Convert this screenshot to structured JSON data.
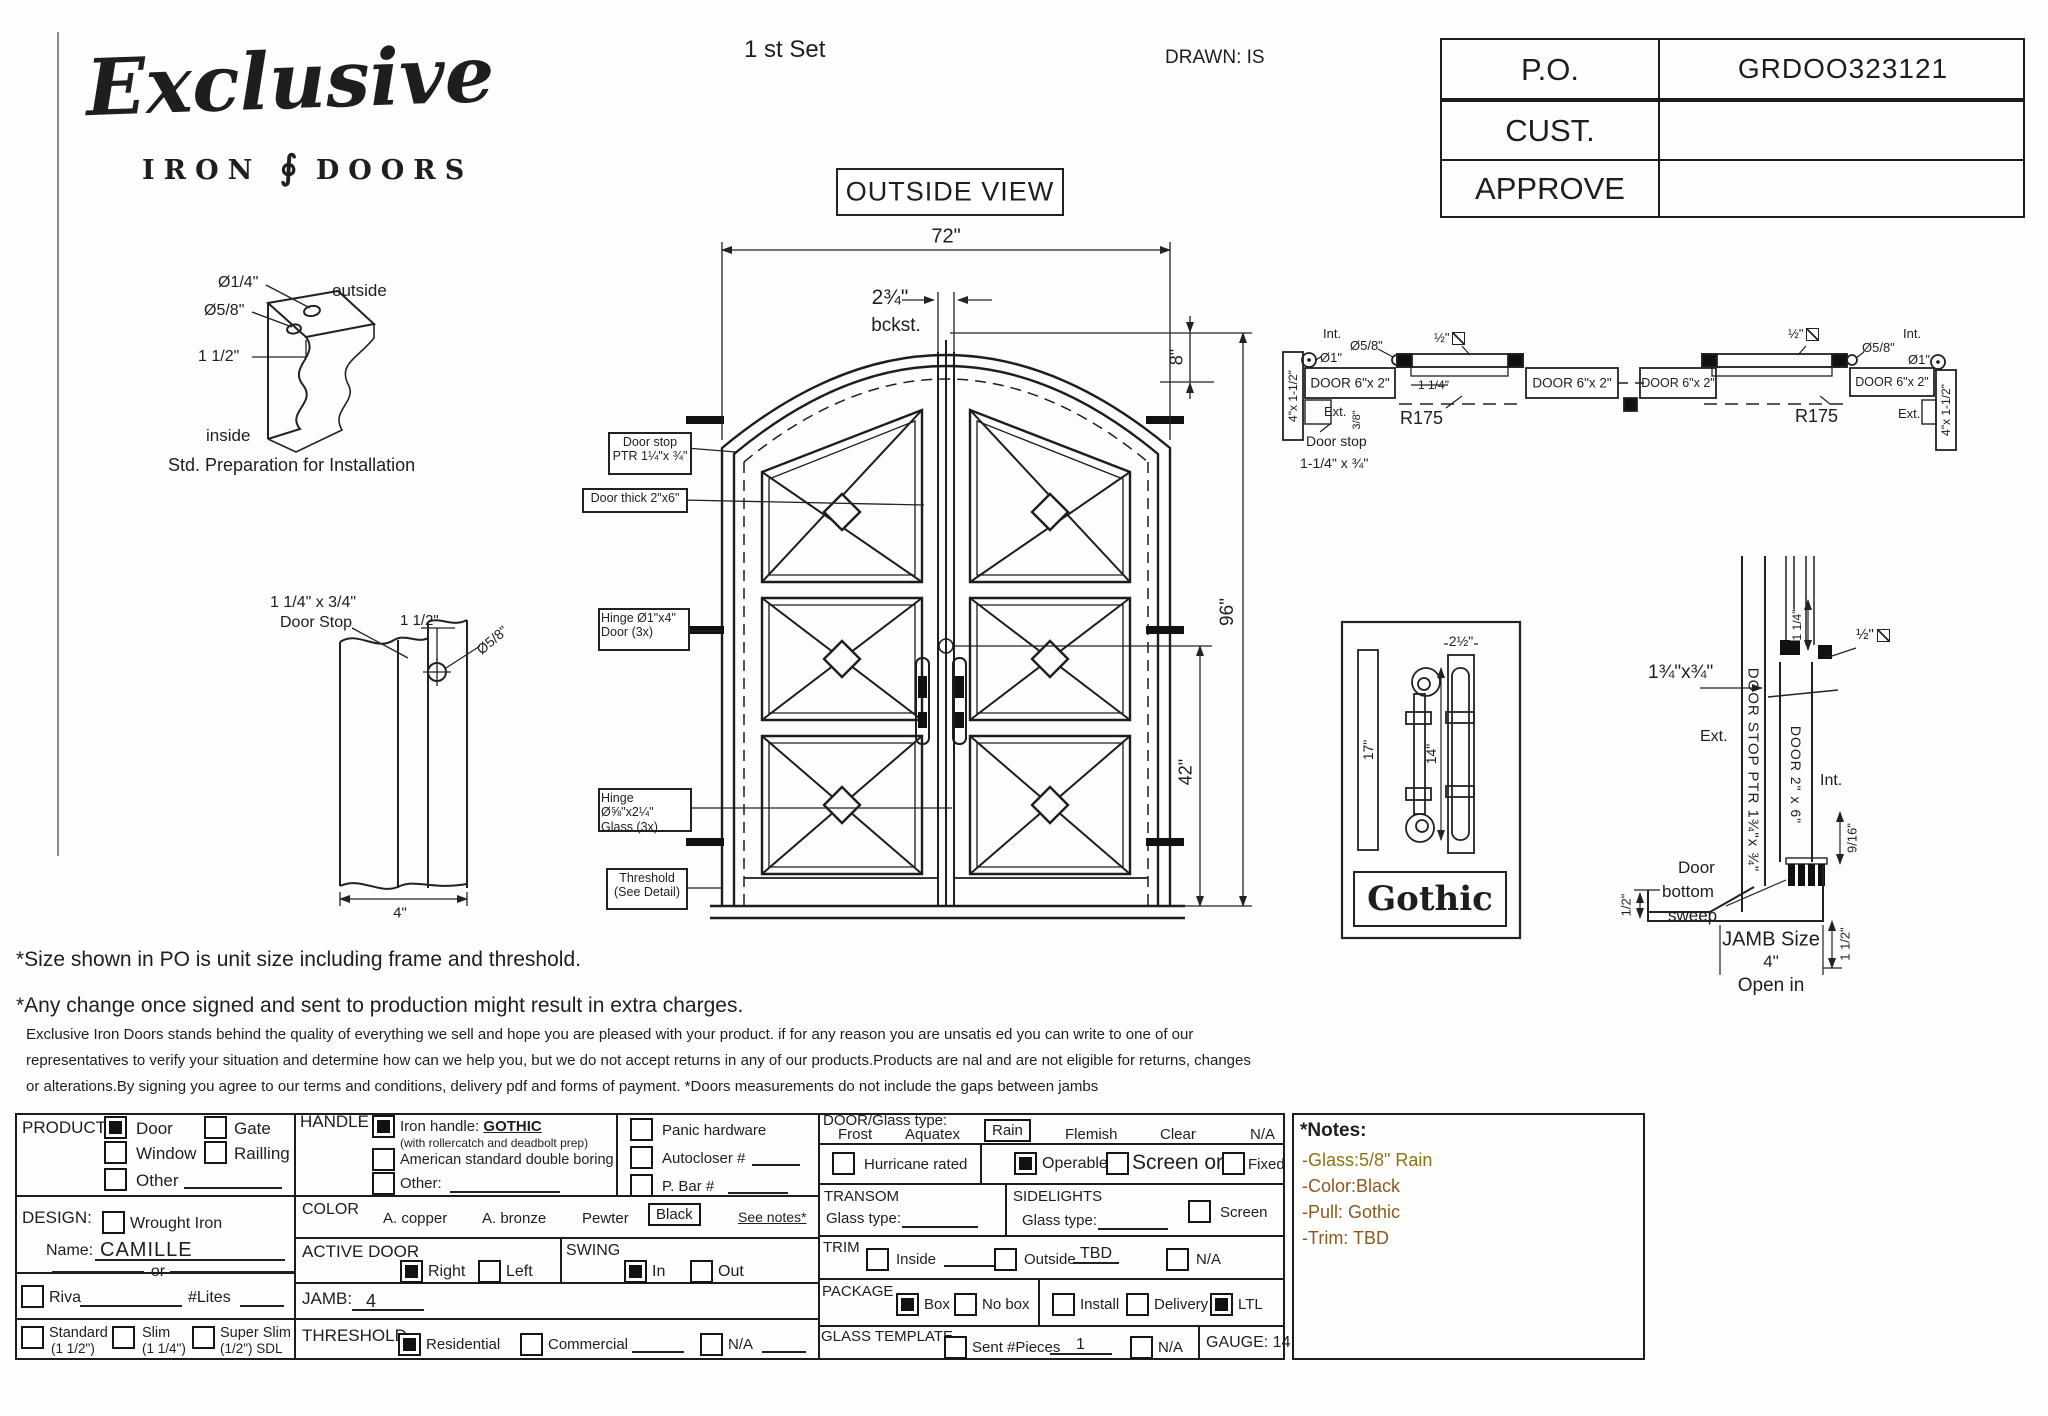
{
  "header": {
    "logo_main": "Exclusive",
    "logo_iron": "IRON",
    "logo_doors": "DOORS",
    "logo_ornament": "∮",
    "set_label": "1 st Set",
    "drawn": "DRAWN: IS",
    "po": {
      "label": "P.O.",
      "value": "GRDOO323121"
    },
    "cust": {
      "label": "CUST.",
      "value": ""
    },
    "approve": {
      "label": "APPROVE",
      "value": ""
    }
  },
  "drawing": {
    "outside_view": "OUTSIDE VIEW",
    "corner": {
      "d1": "Ø1/4\"",
      "d2": "Ø5/8\"",
      "d3": "1 1/2\"",
      "outside": "outside",
      "inside": "inside",
      "caption": "Std. Preparation for Installation"
    },
    "stop": {
      "l1": "1 1/4\" x 3/4\"",
      "l2": "Door Stop",
      "d1": "1 1/2\"",
      "d2": "Ø5/8\"",
      "d3": "4\""
    },
    "door": {
      "w": "72\"",
      "backset": "2¾\"",
      "bckst": "bckst.",
      "arch": "8\"",
      "h": "96\"",
      "handle": "42\"",
      "c1a": "Door stop",
      "c1b": "PTR 1¼\"x ¾\"",
      "c2": "Door thick 2\"x6\"",
      "c3a": "Hinge Ø1\"x4\"",
      "c3b": "Door (3x)",
      "c4a": "Hinge Ø⅝\"x2¼\"",
      "c4b": "Glass (3x)",
      "c5a": "Threshold",
      "c5b": "(See Detail)"
    },
    "hsec": {
      "int": "Int.",
      "int2": "Int.",
      "ext": "Ext.",
      "ext2": "Ext.",
      "d1": "Ø1\"",
      "d1b": "Ø1\"",
      "d58": "Ø5/8\"",
      "d58b": "Ø5/8\"",
      "jamb": "4\"x 1-1/2\"",
      "jamb2": "4\"x 1-1/2\"",
      "door": "DOOR 6\"x 2\"",
      "half": "½\"",
      "r175": "R175",
      "r175b": "R175",
      "q114": "1 1/4\"",
      "e38": "3/8\"",
      "ds1": "Door stop",
      "ds2": "1-1/4\" x ¾\""
    },
    "gothic": {
      "d17": "17\"",
      "d14": "14\"",
      "d25": "2½\"",
      "caption": "Gothic"
    },
    "jsec": {
      "size": "1¾\"x¾\"",
      "vstop": "DOOR STOP PTR 1¾\"x ¾\"",
      "vdoor": "DOOR 2\" x 6\"",
      "q114": "1 1/4\"",
      "half": "½\"",
      "ext": "Ext.",
      "int": "Int.",
      "n916": "9/16\"",
      "sw1": "Door",
      "sw2": "bottom",
      "sw3": "sweep",
      "h12": "1/2\"",
      "jamb1": "JAMB Size",
      "jamb2": "4\"",
      "open": "Open in",
      "oh": "1 1/2\""
    }
  },
  "disclaimer": {
    "line1": "*Size shown in PO is unit size including frame and threshold.",
    "line2": "*Any change once signed and sent to production might result in extra charges.",
    "p1": "Exclusive Iron Doors stands behind the quality of everything we sell and hope you are pleased with your product. if for any reason you are unsatis  ed you can write to one of our",
    "p2": "representatives to verify your situation and determine how can we help you, but we do not accept returns in any of our products.Products are    nal and are not eligible for returns, changes",
    "p3": "or alterations.By signing you agree to our terms and conditions, delivery pdf and forms of payment. *Doors measurements do not include the gaps between jambs"
  },
  "form": {
    "product": {
      "label": "PRODUCT:",
      "door": "Door",
      "gate": "Gate",
      "window": "Window",
      "railling": "Railling",
      "other": "Other"
    },
    "handle": {
      "label": "HANDLE",
      "iron": "Iron handle:",
      "iron_value": "GOTHIC",
      "iron_sub": "(with rollercatch and deadbolt prep)",
      "american": "American standard double boring",
      "other": "Other:"
    },
    "extras": {
      "panic": "Panic hardware",
      "autocloser": "Autocloser #",
      "pbar": "P. Bar #"
    },
    "design": {
      "label": "DESIGN:",
      "wrought": "Wrought Iron",
      "name_label": "Name:",
      "name_value": "CAMILLE",
      "or": "or",
      "riva": "Riva",
      "lites": "#Lites",
      "standard": "Standard",
      "standard_sub": "(1 1/2\")",
      "slim": "Slim",
      "slim_sub": "(1 1/4\")",
      "superslim": "Super Slim",
      "superslim_sub": "(1/2\") SDL"
    },
    "color": {
      "label": "COLOR",
      "copper": "A. copper",
      "bronze": "A. bronze",
      "pewter": "Pewter",
      "black": "Black",
      "see_notes": "See notes*"
    },
    "active": {
      "label": "ACTIVE DOOR",
      "right": "Right",
      "left": "Left",
      "swing": "SWING",
      "in": "In",
      "out": "Out"
    },
    "jamb": {
      "label": "JAMB:",
      "value": "4"
    },
    "threshold": {
      "label": "THRESHOLD",
      "residential": "Residential",
      "commercial": "Commercial",
      "na": "N/A"
    },
    "doorglass": {
      "label": "DOOR/Glass type:",
      "frost": "Frost",
      "aquatex": "Aquatex",
      "rain": "Rain",
      "flemish": "Flemish",
      "clear": "Clear",
      "na": "N/A"
    },
    "hurricane": "Hurricane rated",
    "operable": "Operable",
    "screen_or": "Screen or",
    "fixed": "Fixed",
    "transom": {
      "label": "TRANSOM",
      "glass": "Glass type:"
    },
    "sidelights": {
      "label": "SIDELIGHTS",
      "glass": "Glass type:",
      "screen": "Screen"
    },
    "trim": {
      "label": "TRIM",
      "inside": "Inside",
      "outside": "Outside",
      "tbd": "TBD",
      "na": "N/A"
    },
    "package": {
      "label": "PACKAGE",
      "box": "Box",
      "nobox": "No box",
      "install": "Install",
      "delivery": "Delivery",
      "ltl": "LTL"
    },
    "glass_template": {
      "label": "GLASS TEMPLATE",
      "sent": "Sent #Pieces",
      "pieces": "1",
      "na": "N/A"
    },
    "gauge": "GAUGE: 14",
    "states": {
      "door": true,
      "gate": false,
      "window": false,
      "railling": false,
      "other_product": false,
      "iron_handle": true,
      "american": false,
      "other_handle": false,
      "panic": false,
      "autocloser": false,
      "pbar": false,
      "wrought": false,
      "riva": false,
      "standard": false,
      "slim": false,
      "superslim": false,
      "rain_selected": true,
      "black_selected": true,
      "hurricane": false,
      "operable": true,
      "screen": false,
      "fixed": false,
      "sidelight_screen": false,
      "trim_inside": false,
      "trim_outside": false,
      "trim_na": false,
      "box": true,
      "nobox": false,
      "install": false,
      "delivery": false,
      "ltl": true,
      "sent": false,
      "gt_na": false,
      "right": true,
      "left": false,
      "swing_in": true,
      "swing_out": false,
      "residential": true,
      "commercial": false,
      "thr_na": false
    }
  },
  "notes_box": {
    "title": "*Notes:",
    "lines": [
      "-Glass:5/8\" Rain",
      "-Color:Black",
      "-Pull: Gothic",
      "-Trim: TBD"
    ],
    "color1": "#8a7414",
    "color2": "#8a5a1e"
  }
}
